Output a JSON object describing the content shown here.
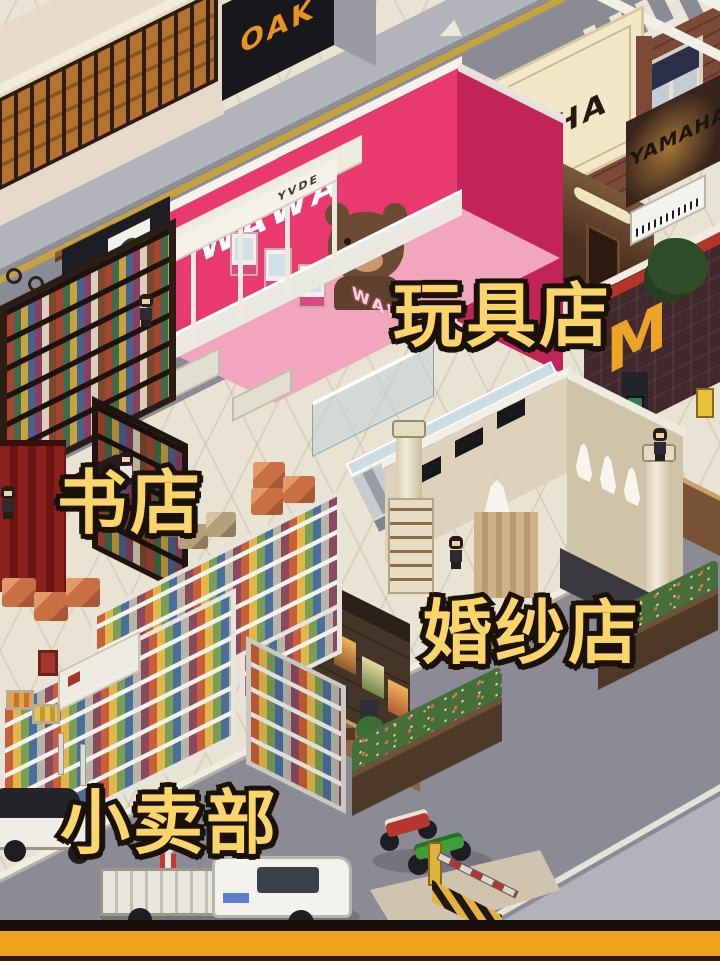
{
  "scene": {
    "name": "isometric-pixel-mall",
    "store_labels": {
      "toy_store": "玩具店",
      "book_store": "书店",
      "wedding_store": "婚纱店",
      "kiosk": "小卖部"
    },
    "signs": {
      "wawa_wall": "WAWA",
      "wawa_neon": "WAWA",
      "yamaha_hall": "YAMAHA",
      "yamaha_shop": "YAMAHA",
      "phone_shop": "YVDE",
      "street_shop": "OAK",
      "arches_logo": "M"
    },
    "colors": {
      "label_fill": "#fbd46a",
      "label_outline": "#1a1208",
      "road": "#8b8b96",
      "mall_floor": "#e8e3d2",
      "toy_store_pink": "#e93a6f",
      "coffee_green": "#2f7d4e",
      "bottom_bar": "#f0a21e"
    }
  }
}
